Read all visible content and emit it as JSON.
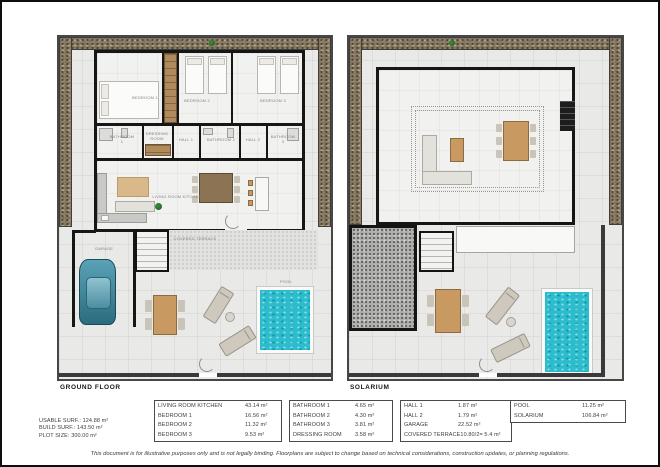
{
  "colors": {
    "pool_water": "#2bbccd",
    "gravel": "#7c6e57",
    "wall": "#161616",
    "floor_tile": "#e9e9e8",
    "wood": "#c89a62",
    "roof_dark": "#aeaeac"
  },
  "ground_floor": {
    "title": "GROUND FLOOR",
    "labels": {
      "bedroom1": "BEDROOM 1",
      "bedroom2": "BEDROOM 2",
      "bedroom3": "BEDROOM 3",
      "bathroom1": "BATHROOM 1",
      "dressing_room": "DRESSING ROOM",
      "hall1": "HALL 1",
      "bathroom2": "BATHROOM 2",
      "hall2": "HALL 2",
      "bathroom3": "BATHROOM 3",
      "living": "LIVING ROOM KITCHEN",
      "garage": "GARAGE",
      "covered_terrace": "COVERED TERRACE",
      "pool": "POOL"
    }
  },
  "solarium": {
    "title": "SOLARIUM"
  },
  "summary": {
    "rows": [
      {
        "label": "USABLE SURF.: ",
        "value": "124.88 m²"
      },
      {
        "label": "BUILD SURF.: ",
        "value": "143.50 m²"
      },
      {
        "label": "PLOT SIZE: ",
        "value": "300.00 m²"
      }
    ]
  },
  "tables": [
    {
      "rows": [
        {
          "label": "LIVING ROOM KITCHEN",
          "value": "43.14 m²"
        },
        {
          "label": "BEDROOM 1",
          "value": "16.56 m²"
        },
        {
          "label": "BEDROOM 2",
          "value": "11.32 m²"
        },
        {
          "label": "BEDROOM 3",
          "value": "9.53 m²"
        }
      ]
    },
    {
      "rows": [
        {
          "label": "BATHROOM 1",
          "value": "4.65 m²"
        },
        {
          "label": "BATHROOM 2",
          "value": "4.30 m²"
        },
        {
          "label": "BATHROOM 3",
          "value": "3.81 m²"
        },
        {
          "label": "DRESSING ROOM",
          "value": "3.58 m²"
        }
      ]
    },
    {
      "rows": [
        {
          "label": "HALL 1",
          "value": "1.87 m²"
        },
        {
          "label": "HALL 2",
          "value": "1.79 m²"
        },
        {
          "label": "GARAGE",
          "value": "22.52 m²"
        },
        {
          "label": "COVERED TERRACE",
          "value": "10.80/2= 5.4 m²"
        }
      ]
    },
    {
      "rows": [
        {
          "label": "POOL",
          "value": "11.25 m²"
        },
        {
          "label": "SOLARIUM",
          "value": "106.84 m²"
        }
      ]
    }
  ],
  "disclaimer": "This document is for illustrative purposes only and is not legally binding. Floorplans are subject to change based on technical considerations, construction updates, or planning regulations."
}
